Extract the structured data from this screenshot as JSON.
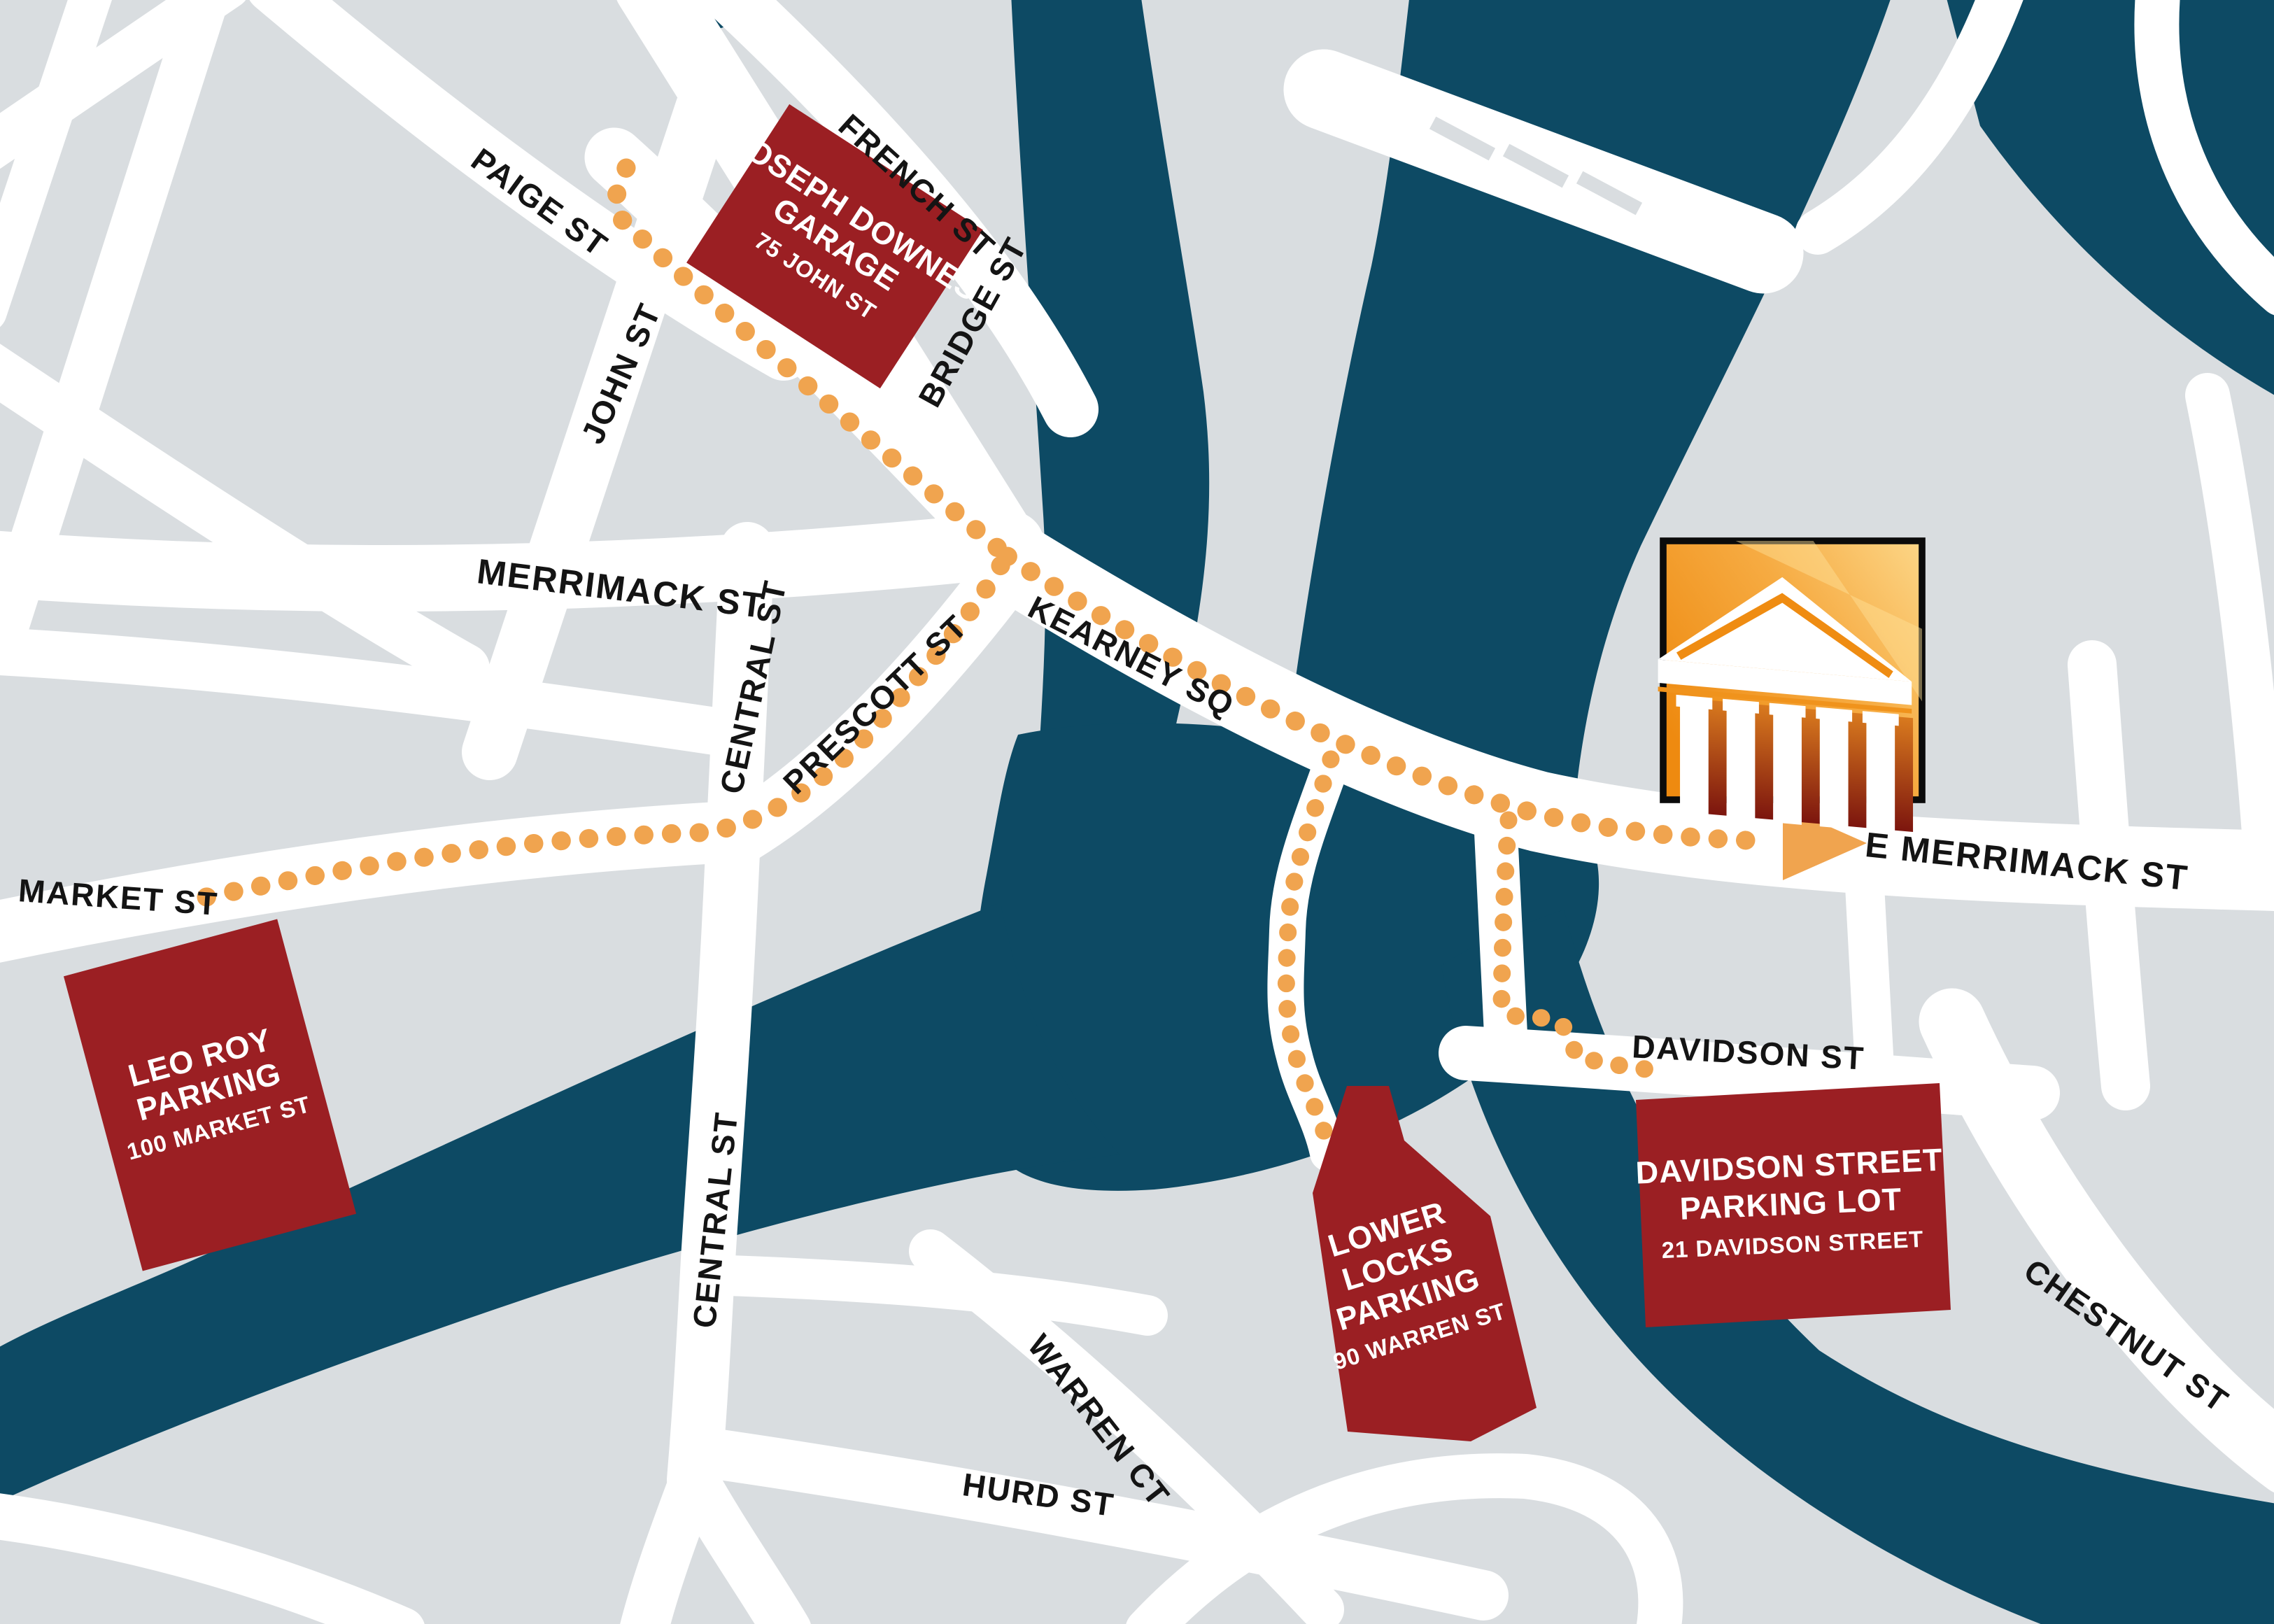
{
  "title": "Downtown parking and directions map",
  "colors": {
    "background": "#d9dde0",
    "street": "#ffffff",
    "river": "#0d4a64",
    "parking": "#9b1f23",
    "route": "#f0a44f",
    "label": "#141414",
    "logo_border": "#0b0b0b"
  },
  "streets": {
    "paige_st": "PAIGE ST",
    "john_st": "JOHN ST",
    "french_st": "FRENCH ST",
    "bridge_st": "BRIDGE ST",
    "merrimack_st": "MERRIMACK ST",
    "central_st": "CENTRAL ST",
    "prescott_st": "PRESCOTT ST",
    "kearney_sq": "KEARNEY SQ",
    "e_merrimack_st": "E MERRIMACK ST",
    "market_st": "MARKET ST",
    "davidson_st": "DAVIDSON ST",
    "chestnut_st": "CHESTNUT ST",
    "warren_ct": "WARREN CT",
    "hurd_st": "HURD ST"
  },
  "parking": {
    "joseph_downes": {
      "line1": "JOSEPH DOWNES",
      "line2": "GARAGE",
      "address": "75 JOHN ST"
    },
    "leo_roy": {
      "line1": "LEO ROY",
      "line2": "PARKING",
      "address": "100 MARKET ST"
    },
    "lower_locks": {
      "line1": "LOWER",
      "line2": "LOCKS",
      "line3": "PARKING",
      "address": "90 WARREN ST"
    },
    "davidson": {
      "line1": "DAVIDSON STREET",
      "line2": "PARKING LOT",
      "address": "21 DAVIDSON STREET"
    }
  },
  "icons": {
    "destination_logo": "classical-temple-columns",
    "route_arrow": "right-pointing-triangle"
  }
}
